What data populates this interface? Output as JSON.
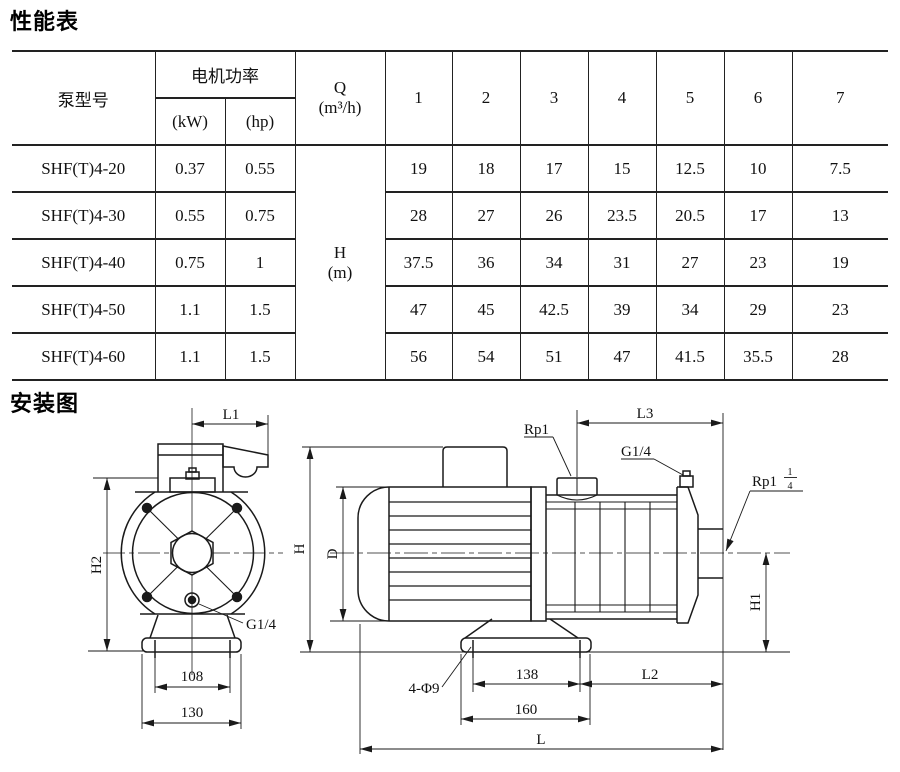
{
  "performance": {
    "title": "性能表",
    "columns": {
      "pump_model": "泵型号",
      "motor_power": "电机功率",
      "kw": "(kW)",
      "hp": "(hp)",
      "q_label": "Q",
      "q_unit": "(m³/h)",
      "h_label": "H",
      "h_unit": "(m)",
      "flow_cols": [
        "1",
        "2",
        "3",
        "4",
        "5",
        "6",
        "7"
      ]
    },
    "rows": [
      {
        "model": "SHF(T)4-20",
        "kw": "0.37",
        "hp": "0.55",
        "heads": [
          "19",
          "18",
          "17",
          "15",
          "12.5",
          "10",
          "7.5"
        ]
      },
      {
        "model": "SHF(T)4-30",
        "kw": "0.55",
        "hp": "0.75",
        "heads": [
          "28",
          "27",
          "26",
          "23.5",
          "20.5",
          "17",
          "13"
        ]
      },
      {
        "model": "SHF(T)4-40",
        "kw": "0.75",
        "hp": "1",
        "heads": [
          "37.5",
          "36",
          "34",
          "31",
          "27",
          "23",
          "19"
        ]
      },
      {
        "model": "SHF(T)4-50",
        "kw": "1.1",
        "hp": "1.5",
        "heads": [
          "47",
          "45",
          "42.5",
          "39",
          "34",
          "29",
          "23"
        ]
      },
      {
        "model": "SHF(T)4-60",
        "kw": "1.1",
        "hp": "1.5",
        "heads": [
          "56",
          "54",
          "51",
          "47",
          "41.5",
          "35.5",
          "28"
        ]
      }
    ]
  },
  "chart_data": {
    "type": "table",
    "title": "性能表",
    "categories_q_m3h": [
      1,
      2,
      3,
      4,
      5,
      6,
      7
    ],
    "value_label": "H (m)",
    "series": [
      {
        "name": "SHF(T)4-20",
        "kw": 0.37,
        "hp": 0.55,
        "values": [
          19,
          18,
          17,
          15,
          12.5,
          10,
          7.5
        ]
      },
      {
        "name": "SHF(T)4-30",
        "kw": 0.55,
        "hp": 0.75,
        "values": [
          28,
          27,
          26,
          23.5,
          20.5,
          17,
          13
        ]
      },
      {
        "name": "SHF(T)4-40",
        "kw": 0.75,
        "hp": 1,
        "values": [
          37.5,
          36,
          34,
          31,
          27,
          23,
          19
        ]
      },
      {
        "name": "SHF(T)4-50",
        "kw": 1.1,
        "hp": 1.5,
        "values": [
          47,
          45,
          42.5,
          39,
          34,
          29,
          23
        ]
      },
      {
        "name": "SHF(T)4-60",
        "kw": 1.1,
        "hp": 1.5,
        "values": [
          56,
          54,
          51,
          47,
          41.5,
          35.5,
          28
        ]
      }
    ]
  },
  "installation": {
    "title": "安装图",
    "front": {
      "l1": "L1",
      "h2": "H2",
      "g14": "G1/4",
      "dim108": "108",
      "dim130": "130"
    },
    "side": {
      "rp1": "Rp1",
      "l3": "L3",
      "g14": "G1/4",
      "rp125_base": "Rp1",
      "rp125_num": "1",
      "rp125_den": "4",
      "h": "H",
      "d": "D",
      "h1": "H1",
      "holes": "4-Φ9",
      "dim138": "138",
      "dim160": "160",
      "l2": "L2",
      "l": "L"
    }
  },
  "colors": {
    "line": "#1a1a1a",
    "text": "#111111",
    "background": "#ffffff"
  }
}
